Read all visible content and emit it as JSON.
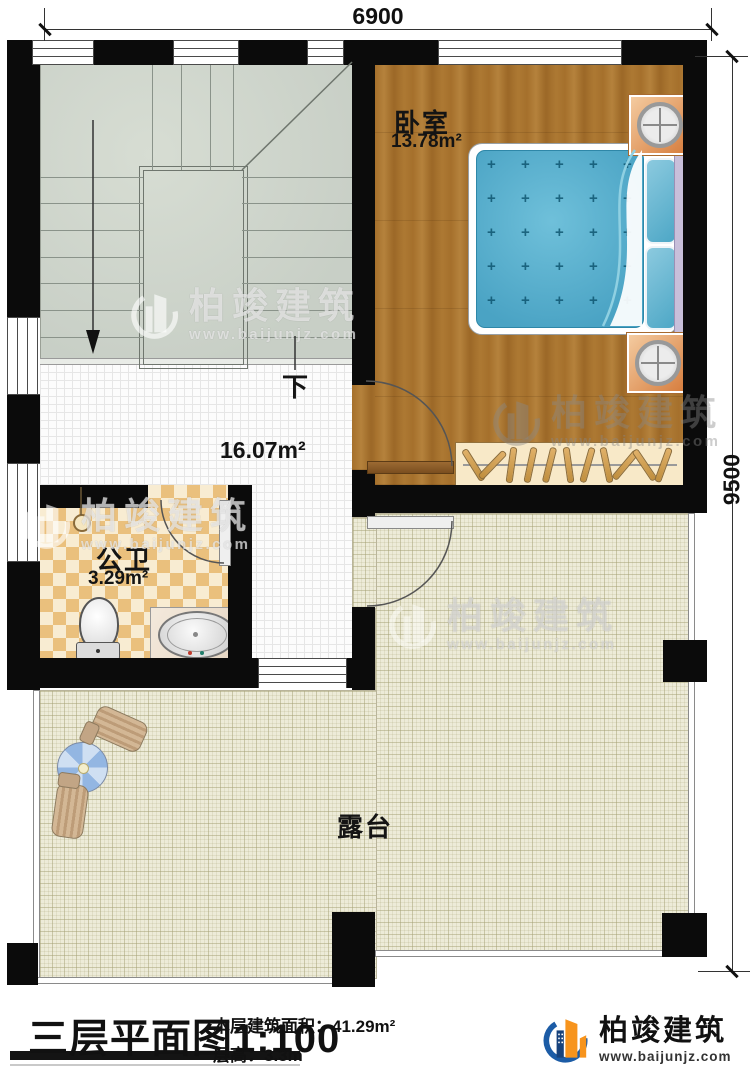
{
  "dimensions": {
    "top": "6900",
    "right": "9500"
  },
  "rooms": {
    "bedroom": {
      "name": "卧室",
      "area": "13.78m²"
    },
    "hall": {
      "area": "16.07m²",
      "direction_label": "下"
    },
    "bathroom": {
      "name": "公卫",
      "area": "3.29m²"
    },
    "terrace": {
      "name": "露台"
    }
  },
  "title_block": {
    "title": "三层平面图1:100",
    "floor_area_label": "本层建筑面积：",
    "floor_area_value": "41.29m²",
    "floor_height_label": "层高：",
    "floor_height_value": "3.3m"
  },
  "branding": {
    "company": "柏竣建筑",
    "website": "www.baijunjz.com"
  },
  "colors": {
    "wall": "#0b0b0b",
    "logo_blue": "#1c5ca6",
    "logo_orange": "#f7941d",
    "mattress_blue": "#4aa3c4"
  }
}
